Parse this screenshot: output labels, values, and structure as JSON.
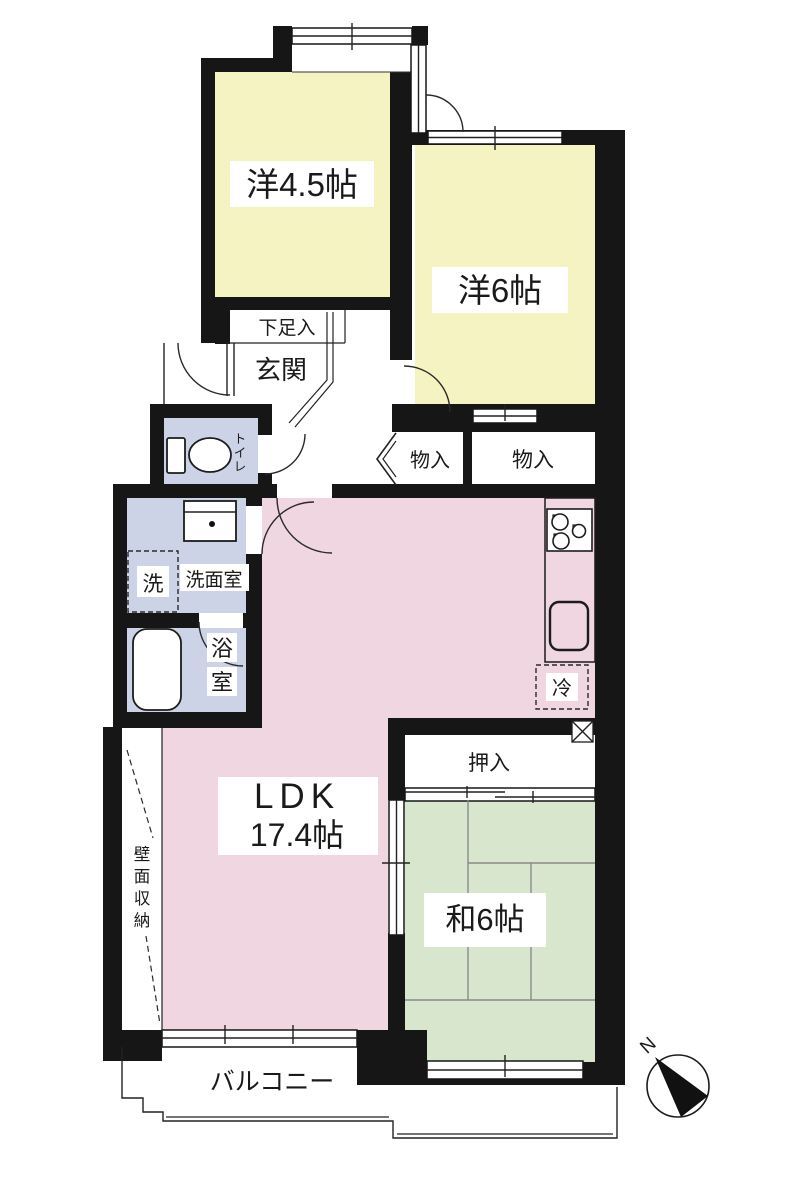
{
  "title": "apartment-floor-plan",
  "colors": {
    "wall": "#161616",
    "western_room": "#f6f3c3",
    "ldk": "#f0d6e0",
    "tatami": "#d7e6cd",
    "wet_area": "#ccd3e6",
    "background": "#ffffff"
  },
  "rooms": {
    "western45": {
      "label": "洋4.5帖"
    },
    "western6": {
      "label": "洋6帖"
    },
    "ldk": {
      "name": "LDK",
      "size": "17.4帖"
    },
    "japanese6": {
      "label": "和6帖"
    },
    "genkan": {
      "label": "玄関"
    },
    "shoe_cabinet": {
      "label": "下足入"
    },
    "toilet": {
      "label": "トイレ",
      "chars": [
        "ト",
        "イ",
        "レ"
      ]
    },
    "washroom": {
      "label": "洗面室"
    },
    "laundry": {
      "label": "洗"
    },
    "bath": {
      "label": "浴室",
      "chars": [
        "浴",
        "室"
      ]
    },
    "storage_left": {
      "label": "物入"
    },
    "storage_right": {
      "label": "物入"
    },
    "refrigerator": {
      "label": "冷"
    },
    "oshiire": {
      "label": "押入"
    },
    "wall_storage": {
      "label": "壁面収納",
      "chars": [
        "壁",
        "面",
        "収",
        "納"
      ]
    },
    "balcony": {
      "label": "バルコニー"
    }
  },
  "compass": {
    "north": "N"
  }
}
